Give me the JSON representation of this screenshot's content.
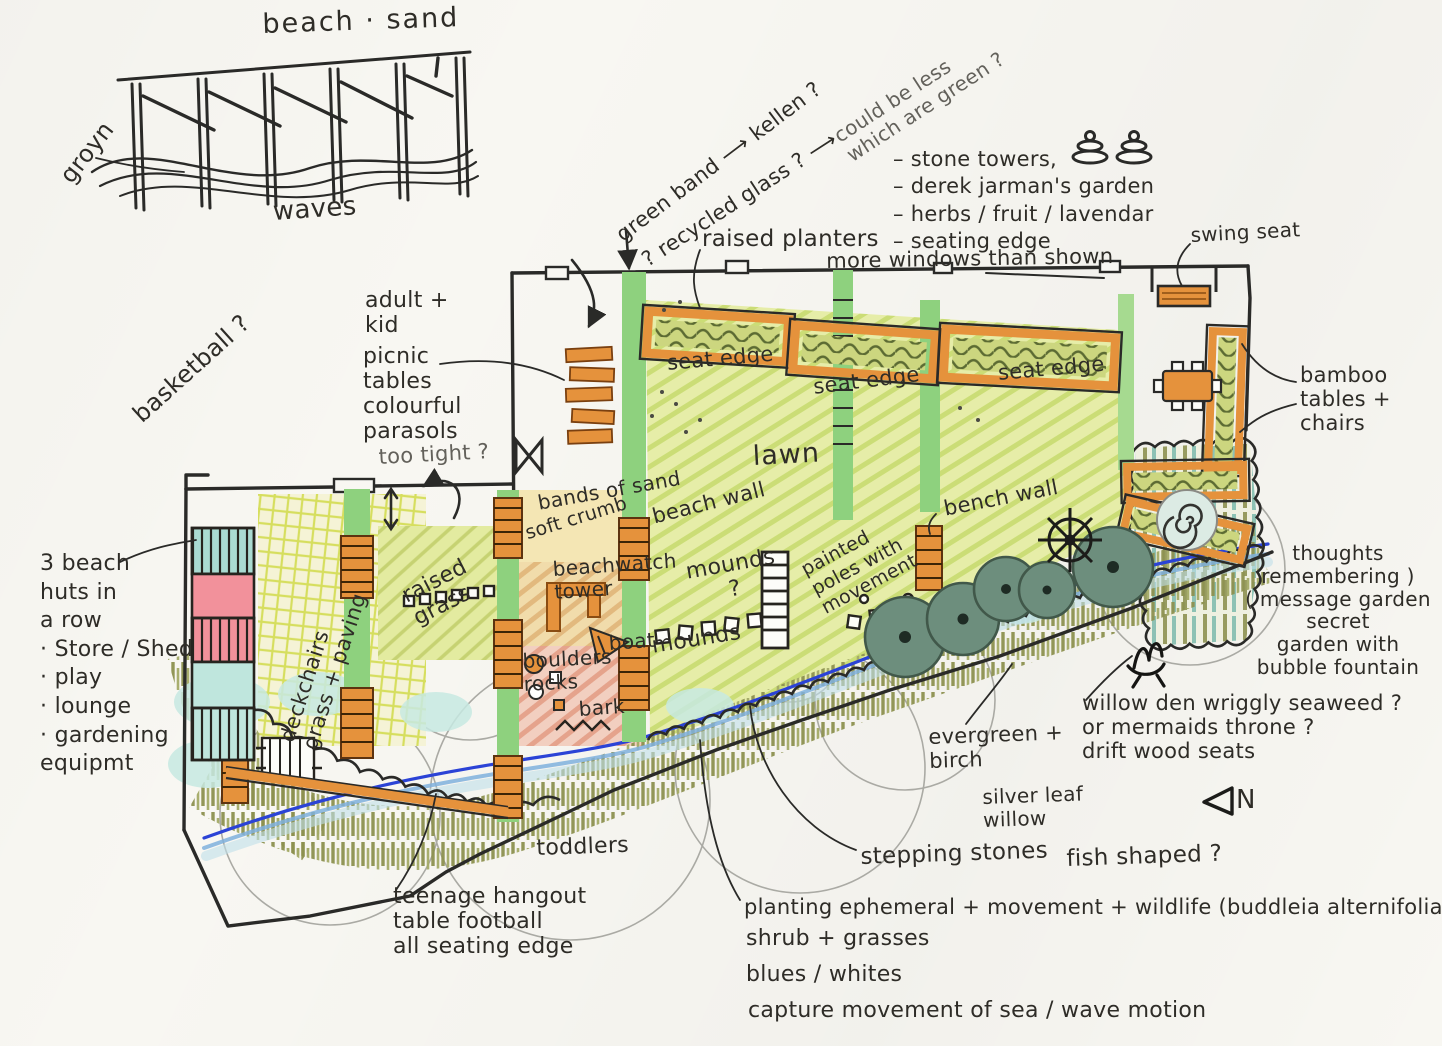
{
  "sketch": {
    "beach_sand": "beach · sand",
    "groyn": "groyn",
    "waves": "waves"
  },
  "notes": {
    "green_band": "green band ⟶ kellen ?",
    "recycled_glass": "? recycled glass ? ⟶",
    "could_be_less": "could be less\nwhich are green ?",
    "raised_planters": "raised planters",
    "garden_list": "– stone towers,\n– derek jarman's garden\n– herbs / fruit / lavendar\n– seating edge",
    "more_windows": "more windows than shown",
    "swing_seat": "swing seat",
    "adult_kid": "adult +\nkid",
    "picnic_tables": "picnic\ntables\ncolourful\nparasols",
    "too_tight": "too tight ?",
    "basketball": "basketball ?",
    "beach_huts": "3 beach\nhuts in\na row\n· Store / Shed\n· play\n· lounge\n· gardening\n   equipmt",
    "deckchairs": "deckchairs\ngrass + paving",
    "raised_grass": "raised\ngrass",
    "bands_of_sand": "bands of sand",
    "soft_crumb": "soft crumb",
    "beachwatch_tower": "beachwatch\n   tower",
    "beach_wall": "beach wall",
    "mounds_q": "mounds\n?",
    "mounds": "mounds",
    "painted_poles": "painted\npoles with\nmovement",
    "boat": "boat",
    "boulders_rocks": "boulders\nrocks",
    "bark": "bark",
    "seat_edge_1": "seat edge",
    "seat_edge_2": "seat edge",
    "seat_edge_3": "seat edge",
    "lawn": "lawn",
    "bench_wall": "bench wall",
    "bamboo_tables": "bamboo\ntables +\n  chairs",
    "thoughts": "thoughts\nremembering )\n( message garden\nsecret\ngarden with\nbubble fountain",
    "willow_den": "willow den wriggly seaweed ?\nor mermaids throne ?\ndrift wood seats",
    "evergreen_birch": "evergreen +\nbirch",
    "silver_leaf_willow": "silver leaf\nwillow",
    "north": "N",
    "toddlers": "toddlers",
    "teenage_hangout": "teenage hangout\ntable football\nall seating edge",
    "stepping_stones": "stepping stones",
    "fish_shaped": "fish shaped ?",
    "planting": "planting ephemeral + movement + wildlife (buddleia alternifolia)",
    "shrub_grasses": "shrub + grasses",
    "blues_whites": "blues / whites",
    "capture_movement": "capture movement of sea / wave motion"
  },
  "icons": {
    "stone_towers": "stacked-pebble cairns",
    "swing_seat": "orange bench",
    "picnic_tables": "stack of orange tables",
    "ship_wheel": "ship wheel",
    "spiral_fountain": "spiral bubble fountain",
    "willow_den": "den scribble",
    "north_arrow": "triangle pointing left",
    "table_football": "table football box",
    "boat": "orange boat",
    "watch_tower": "orange beach-watch tower"
  },
  "colors": {
    "orange": "#e5923c",
    "band_green": "#8ed17e",
    "lawn_green": "#e6eda8",
    "stream_blue": "#2b43d6",
    "hut_teal": "#aadbd2",
    "hut_pink": "#f2919b",
    "olive": "#8d9150",
    "tree_green": "#6d8e7d",
    "ink": "#2a2a28"
  }
}
